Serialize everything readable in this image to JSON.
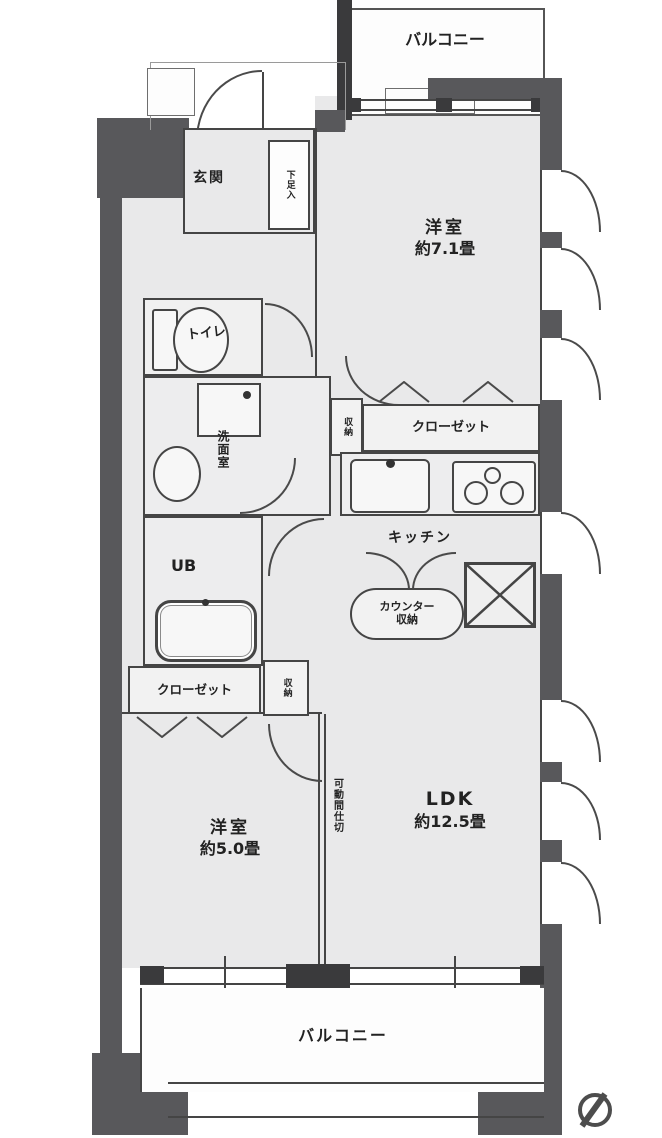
{
  "plan": {
    "balcony_top": "バルコニー",
    "balcony_bottom": "バルコニー",
    "entrance": "玄関",
    "shoe_storage": "下足入",
    "room7_name": "洋室",
    "room7_size": "約7.1畳",
    "toilet": "トイレ",
    "closet_top": "クローゼット",
    "storage_top": "収納",
    "washroom": "洗面室",
    "kitchen": "キッチン",
    "counter_storage_line1": "カウンター",
    "counter_storage_line2": "収納",
    "unit_bath": "UB",
    "closet_bottom": "クローゼット",
    "storage_bottom": "収納",
    "room5_name": "洋室",
    "room5_size": "約5.0畳",
    "partition": "可動間仕切",
    "ldk_name": "LDK",
    "ldk_size": "約12.5畳"
  },
  "colors": {
    "wall": "#58585b",
    "line": "#454545",
    "room_fill": "#e9e9ea",
    "background": "#ffffff"
  }
}
